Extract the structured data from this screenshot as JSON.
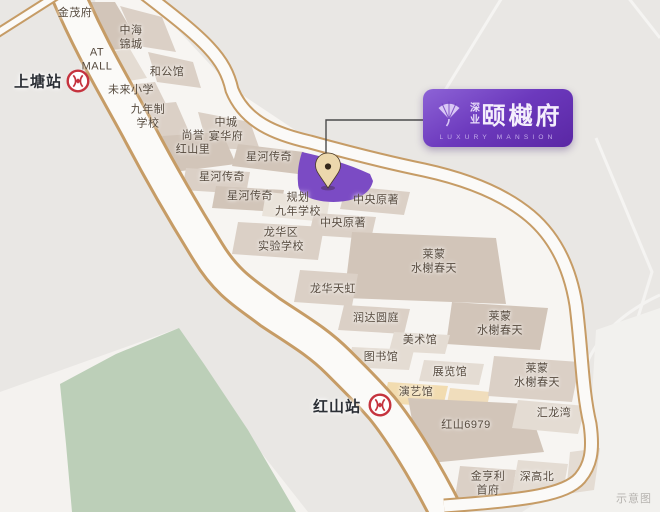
{
  "map": {
    "watermark": "示意图",
    "banner": {
      "developer": "深业",
      "project_name": "颐樾府",
      "subtitle": "LUXURY MANSION"
    },
    "stations": [
      {
        "name": "上塘站",
        "label_x": 38,
        "label_y": 81,
        "icon_x": 78,
        "icon_y": 81
      },
      {
        "name": "红山站",
        "label_x": 337,
        "label_y": 406,
        "icon_x": 380,
        "icon_y": 405
      }
    ],
    "labels": [
      {
        "text": "金茂府",
        "x": 75,
        "y": 13
      },
      {
        "text": "中海\n锦城",
        "x": 131,
        "y": 38
      },
      {
        "text": "AT\nMALL",
        "x": 97,
        "y": 60
      },
      {
        "text": "和公馆",
        "x": 167,
        "y": 72
      },
      {
        "text": "未来小学",
        "x": 131,
        "y": 90
      },
      {
        "text": "九年制\n学校",
        "x": 148,
        "y": 117
      },
      {
        "text": "中城\n宴华府",
        "x": 226,
        "y": 130
      },
      {
        "text": "尚誉\n红山里",
        "x": 193,
        "y": 143
      },
      {
        "text": "星河传奇",
        "x": 269,
        "y": 157
      },
      {
        "text": "星河传奇",
        "x": 222,
        "y": 177
      },
      {
        "text": "星河传奇",
        "x": 250,
        "y": 196
      },
      {
        "text": "规划\n九年学校",
        "x": 298,
        "y": 205
      },
      {
        "text": "中央原著",
        "x": 376,
        "y": 200
      },
      {
        "text": "中央原著",
        "x": 343,
        "y": 223
      },
      {
        "text": "龙华区\n实验学校",
        "x": 281,
        "y": 240
      },
      {
        "text": "莱蒙\n水榭春天",
        "x": 434,
        "y": 262
      },
      {
        "text": "龙华天虹",
        "x": 333,
        "y": 289
      },
      {
        "text": "润达圆庭",
        "x": 376,
        "y": 318
      },
      {
        "text": "莱蒙\n水榭春天",
        "x": 500,
        "y": 324
      },
      {
        "text": "美术馆",
        "x": 420,
        "y": 340
      },
      {
        "text": "图书馆",
        "x": 381,
        "y": 357
      },
      {
        "text": "展览馆",
        "x": 450,
        "y": 372
      },
      {
        "text": "演艺馆",
        "x": 416,
        "y": 392
      },
      {
        "text": "莱蒙\n水榭春天",
        "x": 537,
        "y": 376
      },
      {
        "text": "汇龙湾",
        "x": 554,
        "y": 413
      },
      {
        "text": "红山6979",
        "x": 466,
        "y": 425
      },
      {
        "text": "深高北",
        "x": 537,
        "y": 477
      },
      {
        "text": "金亨利\n首府",
        "x": 488,
        "y": 484
      }
    ],
    "colors": {
      "site_purple": "#7b4bc4",
      "banner_purple": "#5a27a4",
      "metro_red": "#c5333e",
      "road_casing_tan": "#c69c66",
      "park_green": "#bccfb8",
      "block_beige": "#d2c5b9"
    }
  }
}
